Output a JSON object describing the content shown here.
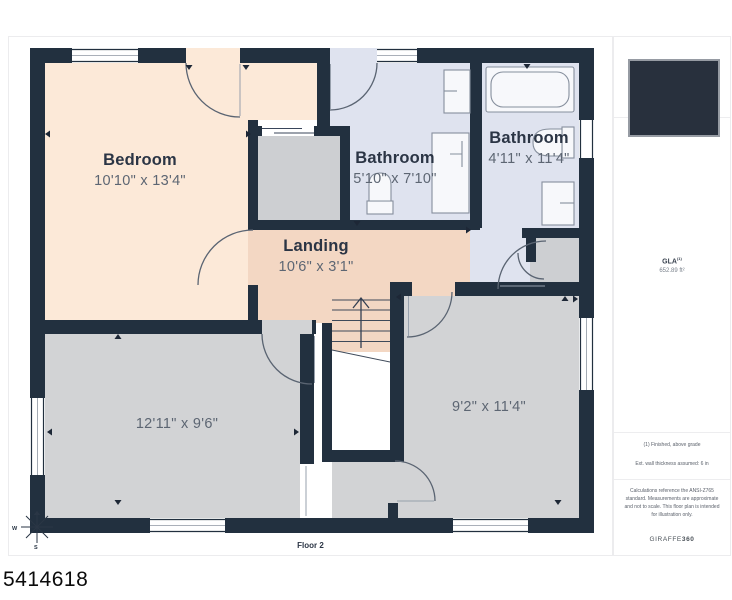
{
  "floor_plan": {
    "floor_label": "Floor 2",
    "photo_id": "5414618",
    "rooms": [
      {
        "name": "Bedroom",
        "dims": "10'10\" x 13'4\""
      },
      {
        "name": "Bathroom",
        "dims": "5'10\" x 7'10\""
      },
      {
        "name": "Bathroom",
        "dims": "4'11\" x 11'4\""
      },
      {
        "name": "Landing",
        "dims": "10'6\" x 3'1\""
      },
      {
        "name": "",
        "dims": "12'11\" x 9'6\""
      },
      {
        "name": "",
        "dims": "9'2\" x 11'4\""
      }
    ],
    "compass": {
      "west": "W",
      "south": "S"
    }
  },
  "sidebar": {
    "gla_label": "GLA",
    "gla_sup": "(1)",
    "gla_value": "652.89 ft²",
    "note_1": "(1) Finished, above grade",
    "note_2": "Ext. wall thickness assumed: 6 in",
    "disclaimer": "Calculations reference the ANSI-Z765 standard. Measurements are approximate and not to scale. This floor plan is intended for illustration only.",
    "brand": "GIRAFFE",
    "brand_suffix": "360"
  },
  "colors": {
    "wall": "#22303f",
    "bedroom": "#fce9d8",
    "landing": "#f3d7c3",
    "bathroom": "#dfe3ef",
    "room_gray": "#d2d3d5",
    "closet_gray": "#cdcfd2",
    "thumbnail": "#28303d"
  }
}
